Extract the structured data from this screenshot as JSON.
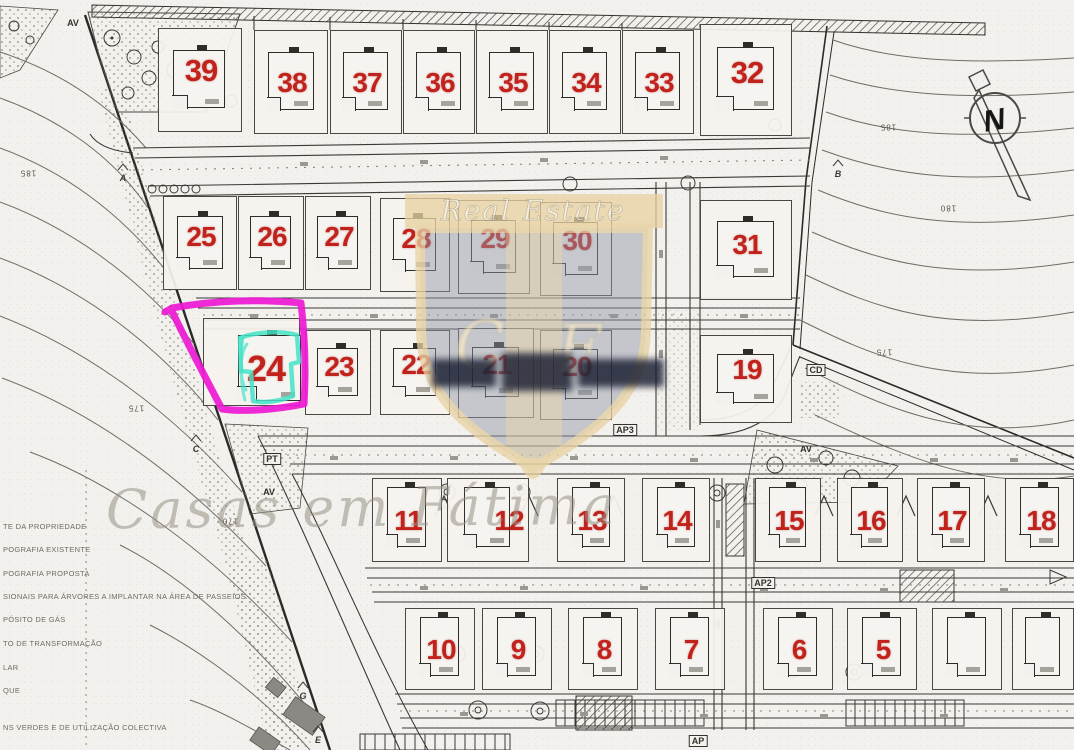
{
  "colors": {
    "paper": "#f3f1ed",
    "ink": "#33312d",
    "contour": "#6f6d67",
    "lot_number_red": "#c2221c",
    "highlight_magenta": "#ee18d4",
    "highlight_teal": "#43e3c7",
    "watermark_beige": "#e7d1a0",
    "watermark_gray": "#8e95a4",
    "watermark_cream": "#f6efdd",
    "watermark_text_gray": "#a39b90",
    "dark_band": "#181d30"
  },
  "compass": {
    "letter": "N"
  },
  "watermark": {
    "top_text": "Real Estate",
    "monogram_left": "C",
    "monogram_right": "F",
    "bottom_text": "Casas em Fátima"
  },
  "highlight": {
    "lot": "24"
  },
  "legend": {
    "lines": [
      {
        "text": "TE DA PROPRIEDADE",
        "y": 527
      },
      {
        "text": "POGRAFIA EXISTENTE",
        "y": 550
      },
      {
        "text": "POGRAFIA PROPOSTA",
        "y": 574
      },
      {
        "text": "SIONAIS PARA ÁRVORES A IMPLANTAR NA ÁREA DE PASSEIOS",
        "y": 597
      },
      {
        "text": "PÓSITO DE GÁS",
        "y": 620
      },
      {
        "text": "TO DE TRANSFORMAÇÃO",
        "y": 644
      },
      {
        "text": "LAR",
        "y": 668
      },
      {
        "text": "QUE",
        "y": 691
      },
      {
        "text": "NS VERDES E DE UTILIZAÇÃO COLECTIVA",
        "y": 728
      }
    ]
  },
  "contour_labels": [
    {
      "text": "185",
      "x": 28,
      "y": 173
    },
    {
      "text": "185",
      "x": 888,
      "y": 127
    },
    {
      "text": "180",
      "x": 948,
      "y": 208
    },
    {
      "text": "175",
      "x": 884,
      "y": 352
    },
    {
      "text": "175",
      "x": 136,
      "y": 408
    },
    {
      "text": "170",
      "x": 230,
      "y": 521
    }
  ],
  "area_labels": [
    {
      "text": "AV",
      "x": 73,
      "y": 23,
      "boxed": false
    },
    {
      "text": "AV",
      "x": 269,
      "y": 492,
      "boxed": false
    },
    {
      "text": "AV",
      "x": 806,
      "y": 449,
      "boxed": false
    },
    {
      "text": "PT",
      "x": 272,
      "y": 459,
      "boxed": true
    },
    {
      "text": "CD",
      "x": 816,
      "y": 370,
      "boxed": true
    },
    {
      "text": "AP3",
      "x": 625,
      "y": 430,
      "boxed": true
    },
    {
      "text": "AP2",
      "x": 763,
      "y": 583,
      "boxed": true
    },
    {
      "text": "AP",
      "x": 698,
      "y": 741,
      "boxed": true
    }
  ],
  "marker_letters": [
    {
      "text": "A",
      "x": 123,
      "y": 178
    },
    {
      "text": "B",
      "x": 838,
      "y": 174
    },
    {
      "text": "C",
      "x": 196,
      "y": 449
    },
    {
      "text": "E",
      "x": 318,
      "y": 740
    },
    {
      "text": "G",
      "x": 303,
      "y": 696
    }
  ],
  "lots": [
    {
      "num": "39",
      "x": 158,
      "y": 28,
      "w": 84,
      "h": 104,
      "fs": 31,
      "ny": 42
    },
    {
      "num": "38",
      "x": 254,
      "y": 30,
      "w": 74,
      "h": 104
    },
    {
      "num": "37",
      "x": 330,
      "y": 30,
      "w": 72,
      "h": 104
    },
    {
      "num": "36",
      "x": 403,
      "y": 30,
      "w": 72,
      "h": 104
    },
    {
      "num": "35",
      "x": 476,
      "y": 30,
      "w": 72,
      "h": 104
    },
    {
      "num": "34",
      "x": 549,
      "y": 30,
      "w": 72,
      "h": 104
    },
    {
      "num": "33",
      "x": 622,
      "y": 30,
      "w": 72,
      "h": 104
    },
    {
      "num": "32",
      "x": 700,
      "y": 24,
      "w": 92,
      "h": 112,
      "fs": 31,
      "ny": 48
    },
    {
      "num": "25",
      "x": 163,
      "y": 196,
      "w": 74,
      "h": 94,
      "ny": 40
    },
    {
      "num": "26",
      "x": 238,
      "y": 196,
      "w": 66,
      "h": 94,
      "ny": 40
    },
    {
      "num": "27",
      "x": 305,
      "y": 196,
      "w": 66,
      "h": 94,
      "ny": 40
    },
    {
      "num": "28",
      "x": 380,
      "y": 198,
      "w": 70,
      "h": 94,
      "ny": 40
    },
    {
      "num": "29",
      "x": 458,
      "y": 200,
      "w": 72,
      "h": 94,
      "ny": 38
    },
    {
      "num": "30",
      "x": 540,
      "y": 202,
      "w": 72,
      "h": 94,
      "ny": 38
    },
    {
      "num": "31",
      "x": 700,
      "y": 200,
      "w": 92,
      "h": 100,
      "ny": 44
    },
    {
      "num": "24",
      "x": 203,
      "y": 318,
      "w": 97,
      "h": 88,
      "fs": 36,
      "nx": 62,
      "ny": 50,
      "hx": 34,
      "hy": 16,
      "hw": 63,
      "hh": 66
    },
    {
      "num": "23",
      "x": 305,
      "y": 330,
      "w": 66,
      "h": 85,
      "ny": 36
    },
    {
      "num": "22",
      "x": 380,
      "y": 330,
      "w": 70,
      "h": 85,
      "ny": 34
    },
    {
      "num": "21",
      "x": 458,
      "y": 328,
      "w": 76,
      "h": 90,
      "ny": 36
    },
    {
      "num": "20",
      "x": 540,
      "y": 330,
      "w": 72,
      "h": 90,
      "ny": 36
    },
    {
      "num": "19",
      "x": 700,
      "y": 335,
      "w": 92,
      "h": 88,
      "ny": 34
    },
    {
      "num": "11",
      "x": 372,
      "y": 478,
      "w": 70,
      "h": 84,
      "t": 1
    },
    {
      "num": "12",
      "x": 447,
      "y": 478,
      "w": 82,
      "h": 84,
      "t": 1,
      "nx": 61
    },
    {
      "num": "13",
      "x": 557,
      "y": 478,
      "w": 68,
      "h": 84,
      "t": 1
    },
    {
      "num": "14",
      "x": 642,
      "y": 478,
      "w": 68,
      "h": 84,
      "t": 1
    },
    {
      "num": "15",
      "x": 755,
      "y": 478,
      "w": 66,
      "h": 84,
      "t": 1
    },
    {
      "num": "16",
      "x": 837,
      "y": 478,
      "w": 66,
      "h": 84,
      "t": 1
    },
    {
      "num": "17",
      "x": 917,
      "y": 478,
      "w": 68,
      "h": 84,
      "t": 1
    },
    {
      "num": "18",
      "x": 1005,
      "y": 478,
      "w": 69,
      "h": 84,
      "t": 1
    },
    {
      "num": "10",
      "x": 405,
      "y": 608,
      "w": 70,
      "h": 82,
      "t": 1
    },
    {
      "num": "9",
      "x": 482,
      "y": 608,
      "w": 70,
      "h": 82,
      "t": 1
    },
    {
      "num": "8",
      "x": 568,
      "y": 608,
      "w": 70,
      "h": 82,
      "t": 1
    },
    {
      "num": "7",
      "x": 655,
      "y": 608,
      "w": 70,
      "h": 82,
      "t": 1
    },
    {
      "num": "6",
      "x": 763,
      "y": 608,
      "w": 70,
      "h": 82,
      "t": 1
    },
    {
      "num": "5",
      "x": 847,
      "y": 608,
      "w": 70,
      "h": 82,
      "t": 1
    },
    {
      "num": "",
      "x": 932,
      "y": 608,
      "w": 70,
      "h": 82,
      "t": 1
    },
    {
      "num": "",
      "x": 1012,
      "y": 608,
      "w": 62,
      "h": 82,
      "t": 1
    }
  ]
}
